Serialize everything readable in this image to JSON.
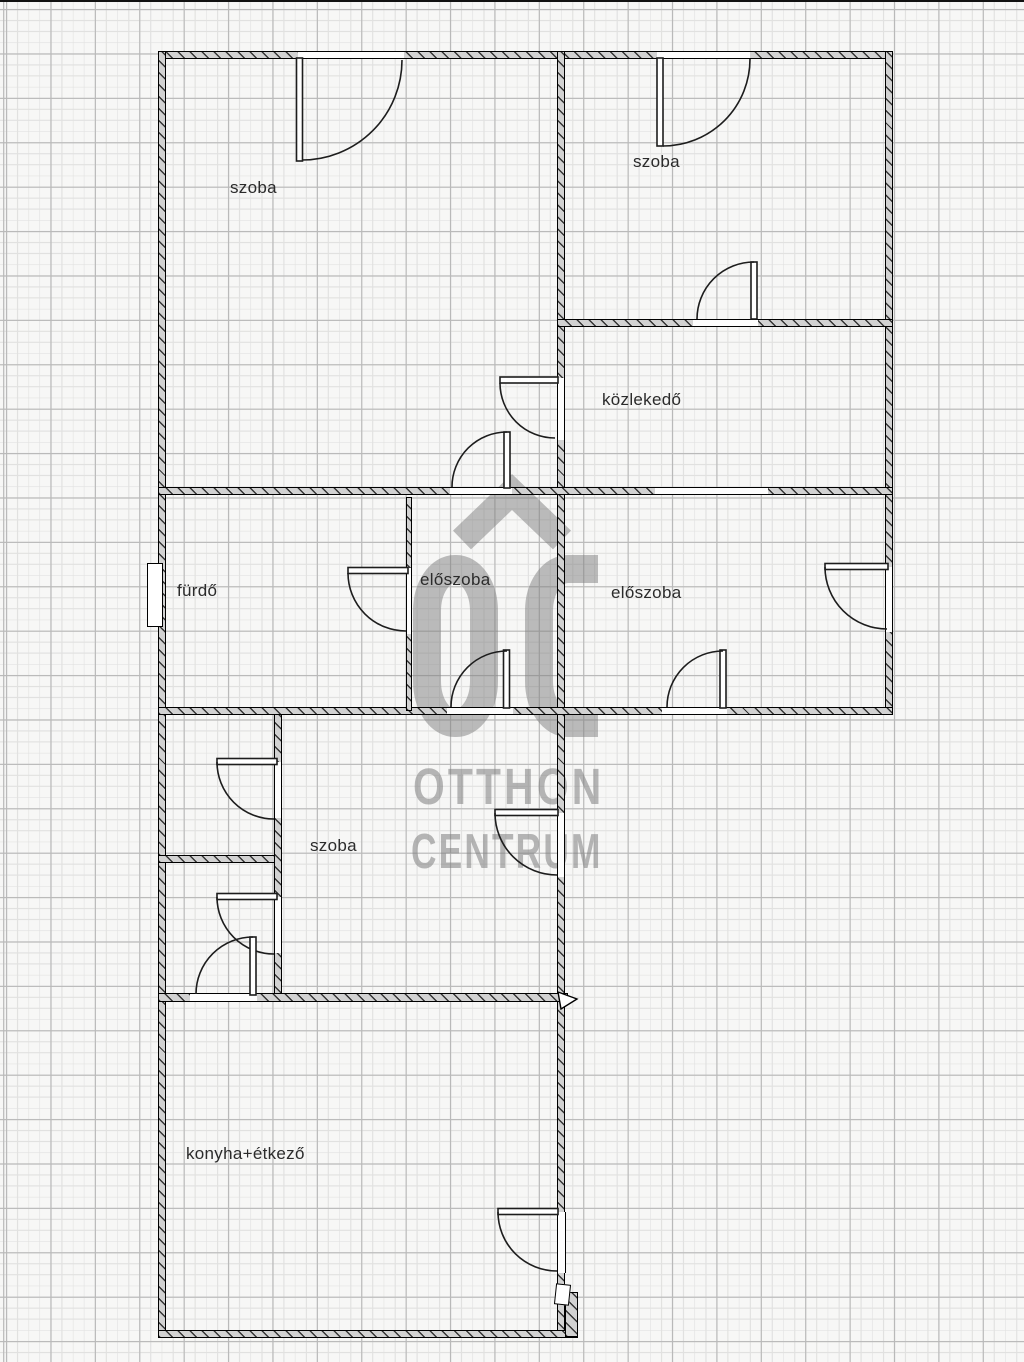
{
  "rooms": [
    {
      "id": "szoba-top-left",
      "label": "szoba"
    },
    {
      "id": "szoba-top-right",
      "label": "szoba"
    },
    {
      "id": "kozlekedo",
      "label": "közlekedő"
    },
    {
      "id": "furdo",
      "label": "fürdő"
    },
    {
      "id": "eloszoba-left",
      "label": "előszoba"
    },
    {
      "id": "eloszoba-right",
      "label": "előszoba"
    },
    {
      "id": "szoba-middle",
      "label": "szoba"
    },
    {
      "id": "konyha-etkezo",
      "label": "konyha+étkező"
    }
  ],
  "watermark": {
    "monogram": "OC",
    "line1": "OTTHON",
    "line2": "CENTRUM"
  },
  "colors": {
    "paper": "#f7f7f6",
    "grid_minor": "#e1e1e0",
    "grid_major": "#b9b9b9",
    "wall_fill": "#d2d2d2",
    "wall_line": "#000000",
    "door_line": "#1d1d1d",
    "watermark_gray": "#7d7d7d",
    "label_text": "#2b2b2b"
  }
}
